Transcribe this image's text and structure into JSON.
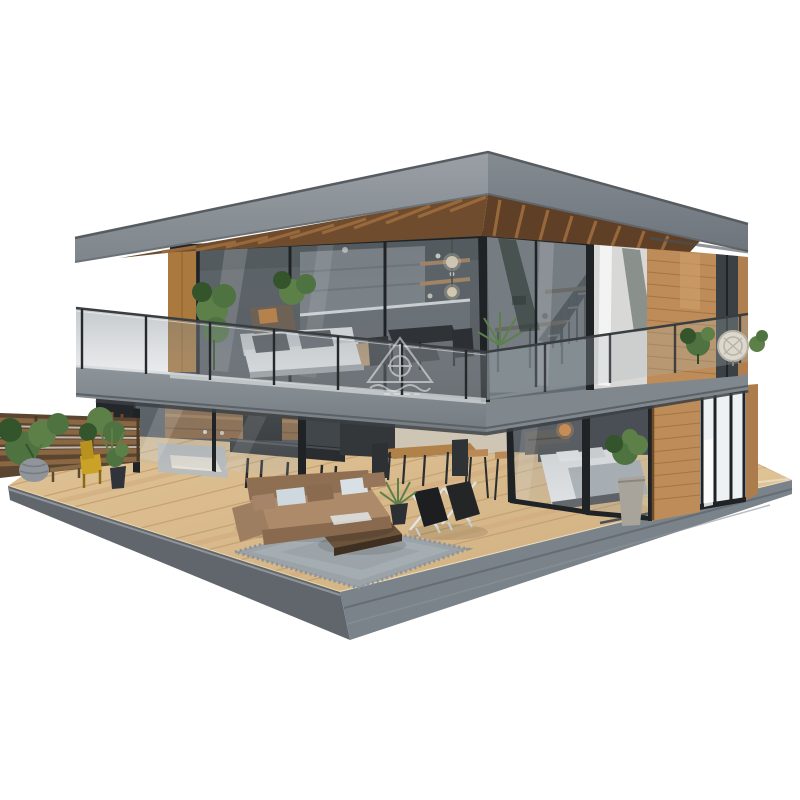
{
  "meta": {
    "kind": "photoreal-architectural-render",
    "subject": "modern two-story glass house with wooden deck, dollhouse cutaway view",
    "background": "#ffffff",
    "no_visible_text": true
  },
  "palette": {
    "background": "#ffffff",
    "roofFascia": "#8a9095",
    "roofFasciaSide": "#7b8289",
    "roofEdgeDark": "#565c60",
    "soffitWood": "#6e4c2d",
    "soffitSlat": "#a06f3f",
    "cedar": "#bd8c58",
    "cedarLight": "#cda06c",
    "cedarDark": "#96693c",
    "frame": "#1f2326",
    "glassTint": "#8b969c",
    "slab": "#80878d",
    "slabSide": "#6f767d",
    "interiorDark": "#41464b",
    "interiorWall": "#cfc5b4",
    "cabinetGray": "#6e747a",
    "counterDark": "#2a2d30",
    "deckWood": "#d9ba8b",
    "deckPlank": "#c19a69",
    "deckEdge": "#60666c",
    "deckEdgeSide": "#7b838a",
    "rug": "#9ba3a9",
    "sofaBrown": "#ad8a69",
    "sofaBrownDark": "#8f6f52",
    "sofaWhite": "#e2e5e7",
    "bedWhite": "#e8eaeb",
    "blanket": "#aeb4b9",
    "plantGreen": "#4e7340",
    "plantMid": "#5d8049",
    "plantDark": "#34552b",
    "lampOrange": "#e8872f",
    "frostedGlass": "#eef1f3",
    "fenceWood": "#8a6642",
    "stonePot": "#8f959a",
    "chairYellow": "#c9a227",
    "watermark": "#ffffff"
  },
  "watermark": {
    "shape": "triangle-pavilion-logo",
    "legible_text": false,
    "opacity": 0.5
  },
  "scene": {
    "elements": [
      "flat-roof",
      "roof-fascia",
      "wood-slat-soffit",
      "upper-floor-glass-walls",
      "upper-kitchen",
      "staircase",
      "pendant-globe-lights",
      "terrace-white-sofa",
      "terrace-dining-set",
      "terrace-plants",
      "cedar-wall-upper",
      "balcony-glass-railing",
      "concrete-floor-slab",
      "lower-kitchen",
      "wall-tv",
      "kitchen-island-stools",
      "dining-table-chairs",
      "glass-bedroom",
      "bed",
      "orange-pendant-lamp",
      "bedroom-plant",
      "cedar-column",
      "frosted-windows",
      "wooden-deck",
      "deck-gray-base",
      "sliding-door-tracks",
      "garden-fence",
      "garden-plants",
      "stone-planter",
      "yellow-chair",
      "garden-bench",
      "outdoor-brown-sofa",
      "throw-pillows",
      "area-rug",
      "coffee-table",
      "folding-deck-chairs",
      "deck-potted-plant",
      "watermark-logo"
    ]
  }
}
